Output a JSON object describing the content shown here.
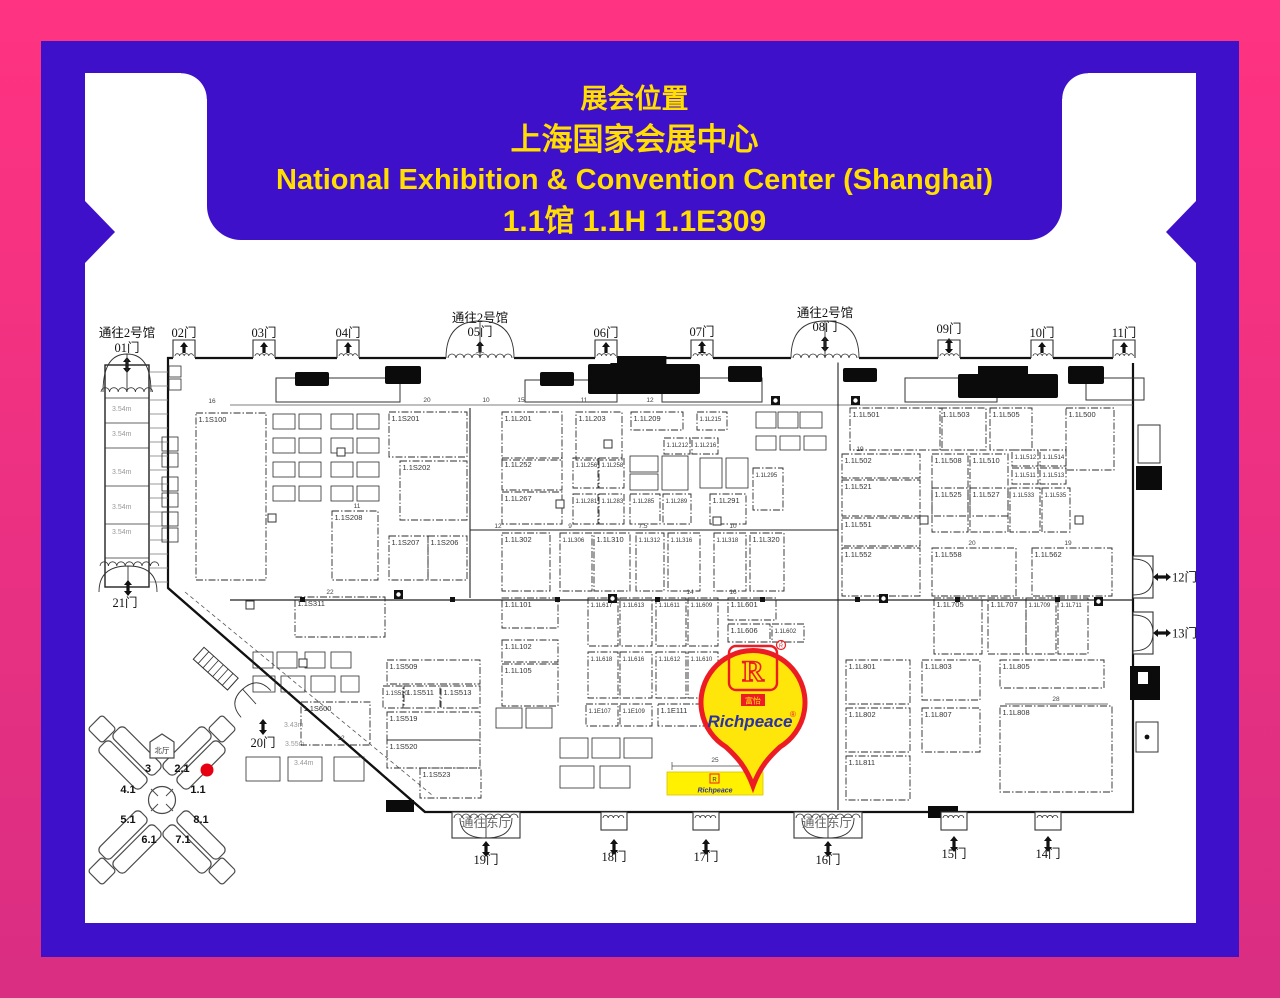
{
  "colors": {
    "frame_pink_top": "#FF3381",
    "frame_pink_bottom": "#D92E82",
    "panel_blue": "#3F10C9",
    "title_yellow": "#FFDE00",
    "pin_red": "#ED1C24",
    "pin_yellow": "#FFE60A",
    "booth_yellow": "#FFF100",
    "brand_blue": "#2B32A3",
    "marker_red": "#E60012"
  },
  "banner": {
    "line1": "展会位置",
    "line2": "上海国家会展中心",
    "line3": "National Exhibition & Convention Center (Shanghai)",
    "line4": "1.1馆 1.1H 1.1E309"
  },
  "map": {
    "heights_corridor": {
      "text": "3.54m",
      "x": 112,
      "ys": [
        411,
        436,
        474,
        509,
        534
      ]
    },
    "heights_diagonal": [
      {
        "text": "3.43m",
        "x": 284,
        "y": 727
      },
      {
        "text": "3.55m",
        "x": 285,
        "y": 746
      },
      {
        "text": "3.44m",
        "x": 294,
        "y": 765
      }
    ],
    "gates_top": [
      {
        "label": "01门",
        "x": 127,
        "y": 352,
        "pass": "通往2号馆",
        "passY": 337,
        "arch": "corridor"
      },
      {
        "label": "02门",
        "x": 184,
        "y": 337
      },
      {
        "label": "03门",
        "x": 264,
        "y": 337
      },
      {
        "label": "04门",
        "x": 348,
        "y": 337
      },
      {
        "label": "05门",
        "x": 480,
        "y": 336,
        "pass": "通往2号馆",
        "passY": 322,
        "arch": true
      },
      {
        "label": "06门",
        "x": 606,
        "y": 337
      },
      {
        "label": "07门",
        "x": 702,
        "y": 336
      },
      {
        "label": "08门",
        "x": 825,
        "y": 331,
        "pass": "通往2号馆",
        "passY": 317,
        "arch": true
      },
      {
        "label": "09门",
        "x": 949,
        "y": 333
      },
      {
        "label": "10门",
        "x": 1042,
        "y": 337
      },
      {
        "label": "11门",
        "x": 1124,
        "y": 337
      }
    ],
    "gates_bottom": [
      {
        "label": "19门",
        "x": 486,
        "y": 864,
        "wide": true
      },
      {
        "label": "18门",
        "x": 614,
        "y": 861
      },
      {
        "label": "17门",
        "x": 706,
        "y": 861
      },
      {
        "label": "16门",
        "x": 828,
        "y": 864,
        "wide": true
      },
      {
        "label": "15门",
        "x": 954,
        "y": 858
      },
      {
        "label": "14门",
        "x": 1048,
        "y": 858
      }
    ],
    "gates_right": [
      {
        "label": "12门",
        "y": 577
      },
      {
        "label": "13门",
        "y": 633
      }
    ],
    "gate_20": {
      "label": "20门",
      "x": 263,
      "y": 747
    },
    "gate_21": {
      "label": "21门",
      "x": 125,
      "y": 607
    },
    "east_passages": [
      {
        "text": "通往东厅",
        "x": 486,
        "y": 827
      },
      {
        "text": "通往东厅",
        "x": 827,
        "y": 827
      }
    ],
    "booths": [
      [
        "1.1S100",
        196,
        413,
        70,
        167
      ],
      [
        "1.1S201",
        389,
        412,
        78,
        45
      ],
      [
        "1.1S202",
        400,
        461,
        67,
        59
      ],
      [
        "1.1S208",
        332,
        511,
        46,
        69
      ],
      [
        "1.1S207",
        389,
        536,
        39,
        44
      ],
      [
        "1.1S206",
        428,
        536,
        39,
        44
      ],
      [
        "1.1S311",
        295,
        597,
        90,
        40
      ],
      [
        "1.1S509",
        387,
        660,
        93,
        24
      ],
      [
        "1.1S510",
        383,
        686,
        20,
        22
      ],
      [
        "1.1S511",
        404,
        686,
        36,
        22
      ],
      [
        "1.1S513",
        441,
        686,
        39,
        22
      ],
      [
        "1.1S519",
        387,
        712,
        93,
        28
      ],
      [
        "1.1S520",
        387,
        740,
        93,
        28
      ],
      [
        "1.1S523",
        420,
        768,
        61,
        30
      ],
      [
        "1.1S600",
        301,
        702,
        69,
        43
      ],
      [
        "1.1L201",
        502,
        412,
        60,
        48
      ],
      [
        "1.1L203",
        576,
        412,
        46,
        48
      ],
      [
        "1.1L209",
        631,
        412,
        52,
        18
      ],
      [
        "1.1L215",
        697,
        412,
        30,
        18
      ],
      [
        "1.1L212",
        664,
        438,
        26,
        16
      ],
      [
        "1.1L216",
        692,
        438,
        26,
        16
      ],
      [
        "1.1L252",
        502,
        458,
        60,
        32
      ],
      [
        "1.1L256",
        573,
        458,
        25,
        30
      ],
      [
        "1.1L258",
        599,
        458,
        25,
        30
      ],
      [
        "1.1L295",
        753,
        468,
        30,
        42
      ],
      [
        "1.1L267",
        502,
        492,
        60,
        32
      ],
      [
        "1.1L281",
        573,
        494,
        25,
        30
      ],
      [
        "1.1L283",
        599,
        494,
        25,
        30
      ],
      [
        "1.1L285",
        630,
        494,
        30,
        30
      ],
      [
        "1.1L289",
        663,
        494,
        28,
        30
      ],
      [
        "1.1L291",
        710,
        494,
        36,
        30
      ],
      [
        "1.1L302",
        502,
        533,
        48,
        58
      ],
      [
        "1.1L306",
        560,
        533,
        32,
        58
      ],
      [
        "1.1L310",
        594,
        533,
        36,
        58
      ],
      [
        "1.1L312",
        636,
        533,
        28,
        58
      ],
      [
        "1.1L316",
        668,
        533,
        32,
        58
      ],
      [
        "1.1L318",
        714,
        533,
        32,
        58
      ],
      [
        "1.1L320",
        750,
        533,
        34,
        58
      ],
      [
        "1.1L101",
        502,
        598,
        56,
        30
      ],
      [
        "1.1L102",
        502,
        640,
        56,
        22
      ],
      [
        "1.1L105",
        502,
        664,
        56,
        42
      ],
      [
        "1.1L617",
        588,
        598,
        30,
        48
      ],
      [
        "1.1L613",
        620,
        598,
        32,
        48
      ],
      [
        "1.1L611",
        656,
        598,
        30,
        48
      ],
      [
        "1.1L609",
        688,
        598,
        30,
        48
      ],
      [
        "1.1L601",
        728,
        598,
        48,
        22
      ],
      [
        "1.1L606",
        728,
        624,
        42,
        18
      ],
      [
        "1.1L602",
        772,
        624,
        32,
        18
      ],
      [
        "1.1L618",
        588,
        652,
        30,
        46
      ],
      [
        "1.1L616",
        620,
        652,
        32,
        46
      ],
      [
        "1.1L612",
        656,
        652,
        30,
        46
      ],
      [
        "1.1L610",
        688,
        652,
        30,
        46
      ],
      [
        "1.1E107",
        586,
        704,
        32,
        22
      ],
      [
        "1.1E109",
        620,
        704,
        32,
        22
      ],
      [
        "1.1E111",
        658,
        704,
        46,
        22
      ],
      [
        "1.1L501",
        850,
        408,
        92,
        42
      ],
      [
        "1.1L503",
        940,
        408,
        46,
        42
      ],
      [
        "1.1L505",
        990,
        408,
        42,
        42
      ],
      [
        "1.1L500",
        1066,
        408,
        48,
        62
      ],
      [
        "1.1L502",
        842,
        454,
        78,
        24
      ],
      [
        "1.1L521",
        842,
        480,
        78,
        36
      ],
      [
        "1.1L508",
        932,
        454,
        36,
        62
      ],
      [
        "1.1L510",
        970,
        454,
        38,
        62
      ],
      [
        "1.1L512",
        1012,
        450,
        26,
        16
      ],
      [
        "1.1L514",
        1040,
        450,
        26,
        16
      ],
      [
        "1.1L511",
        1012,
        468,
        26,
        16
      ],
      [
        "1.1L513",
        1040,
        468,
        26,
        16
      ],
      [
        "1.1L525",
        932,
        488,
        36,
        44
      ],
      [
        "1.1L527",
        970,
        488,
        38,
        44
      ],
      [
        "1.1L533",
        1010,
        488,
        30,
        44
      ],
      [
        "1.1L535",
        1042,
        488,
        28,
        44
      ],
      [
        "1.1L551",
        842,
        518,
        78,
        28
      ],
      [
        "1.1L552",
        842,
        548,
        78,
        48
      ],
      [
        "1.1L558",
        932,
        548,
        84,
        48
      ],
      [
        "1.1L562",
        1032,
        548,
        80,
        48
      ],
      [
        "1.1L705",
        934,
        598,
        48,
        56
      ],
      [
        "1.1L707",
        988,
        598,
        38,
        56
      ],
      [
        "1.1L709",
        1026,
        598,
        30,
        56
      ],
      [
        "1.1L711",
        1058,
        598,
        30,
        56
      ],
      [
        "1.1L801",
        846,
        660,
        64,
        44
      ],
      [
        "1.1L802",
        846,
        708,
        64,
        44
      ],
      [
        "1.1L811",
        846,
        756,
        64,
        44
      ],
      [
        "1.1L803",
        922,
        660,
        58,
        40
      ],
      [
        "1.1L805",
        1000,
        660,
        104,
        28
      ],
      [
        "1.1L807",
        922,
        708,
        58,
        44
      ],
      [
        "1.1L808",
        1000,
        706,
        112,
        86
      ]
    ],
    "blocks": [
      [
        162,
        437,
        16,
        14
      ],
      [
        162,
        453,
        16,
        14
      ],
      [
        162,
        477,
        16,
        14
      ],
      [
        162,
        493,
        16,
        14
      ],
      [
        162,
        512,
        16,
        14
      ],
      [
        162,
        528,
        16,
        14
      ],
      [
        273,
        414,
        22,
        15
      ],
      [
        299,
        414,
        22,
        15
      ],
      [
        331,
        414,
        22,
        15
      ],
      [
        357,
        414,
        22,
        15
      ],
      [
        273,
        438,
        22,
        15
      ],
      [
        299,
        438,
        22,
        15
      ],
      [
        331,
        438,
        22,
        15
      ],
      [
        357,
        438,
        22,
        15
      ],
      [
        273,
        462,
        22,
        15
      ],
      [
        299,
        462,
        22,
        15
      ],
      [
        331,
        462,
        22,
        15
      ],
      [
        357,
        462,
        22,
        15
      ],
      [
        273,
        486,
        22,
        15
      ],
      [
        299,
        486,
        22,
        15
      ],
      [
        331,
        486,
        22,
        15
      ],
      [
        357,
        486,
        22,
        15
      ],
      [
        756,
        412,
        20,
        16
      ],
      [
        778,
        412,
        20,
        16
      ],
      [
        800,
        412,
        22,
        16
      ],
      [
        756,
        436,
        20,
        14
      ],
      [
        780,
        436,
        20,
        14
      ],
      [
        804,
        436,
        22,
        14
      ],
      [
        630,
        456,
        28,
        16
      ],
      [
        630,
        474,
        28,
        16
      ],
      [
        662,
        456,
        26,
        34
      ],
      [
        700,
        458,
        22,
        30
      ],
      [
        726,
        458,
        22,
        30
      ],
      [
        560,
        738,
        28,
        20
      ],
      [
        592,
        738,
        28,
        20
      ],
      [
        624,
        738,
        28,
        20
      ],
      [
        560,
        766,
        34,
        22
      ],
      [
        600,
        766,
        30,
        22
      ],
      [
        253,
        652,
        20,
        16
      ],
      [
        277,
        652,
        20,
        16
      ],
      [
        305,
        652,
        20,
        16
      ],
      [
        331,
        652,
        20,
        16
      ],
      [
        253,
        676,
        22,
        16
      ],
      [
        281,
        676,
        24,
        16
      ],
      [
        311,
        676,
        24,
        16
      ],
      [
        341,
        676,
        18,
        16
      ],
      [
        246,
        757,
        34,
        24
      ],
      [
        288,
        757,
        34,
        24
      ],
      [
        334,
        757,
        30,
        24
      ],
      [
        496,
        708,
        26,
        20
      ],
      [
        526,
        708,
        26,
        20
      ],
      [
        169,
        366,
        12,
        11
      ],
      [
        169,
        379,
        12,
        11
      ]
    ],
    "desks": [
      [
        276,
        378,
        124,
        24
      ],
      [
        525,
        380,
        92,
        22
      ],
      [
        662,
        378,
        100,
        24
      ],
      [
        905,
        378,
        92,
        24
      ],
      [
        1086,
        378,
        58,
        22
      ]
    ],
    "furniture": [
      [
        295,
        372,
        34,
        14,
        0
      ],
      [
        385,
        366,
        36,
        18,
        0
      ],
      [
        540,
        372,
        34,
        14,
        0
      ],
      [
        588,
        364,
        112,
        30,
        1
      ],
      [
        728,
        366,
        34,
        16,
        0
      ],
      [
        843,
        368,
        34,
        14,
        0
      ],
      [
        958,
        374,
        100,
        24,
        1
      ],
      [
        1068,
        366,
        36,
        18,
        0
      ]
    ],
    "dims": [
      [
        "16",
        212,
        403
      ],
      [
        "20",
        427,
        402
      ],
      [
        "10",
        486,
        402
      ],
      [
        "15",
        521,
        402
      ],
      [
        "11",
        584,
        402
      ],
      [
        "12",
        650,
        402
      ],
      [
        "19",
        860,
        451
      ],
      [
        "22",
        330,
        594
      ],
      [
        "11",
        357,
        508
      ],
      [
        "14",
        690,
        594
      ],
      [
        "16",
        733,
        594
      ],
      [
        "12",
        498,
        528
      ],
      [
        "9",
        570,
        528
      ],
      [
        "7.5",
        643,
        528
      ],
      [
        "10",
        733,
        528
      ],
      [
        "20",
        972,
        545
      ],
      [
        "19",
        1068,
        545
      ],
      [
        "25",
        715,
        762
      ],
      [
        "28",
        1056,
        701
      ],
      [
        "12",
        341,
        740
      ]
    ],
    "aisle_dots": [
      300,
      450,
      555,
      655,
      760,
      855,
      955,
      1055
    ],
    "hollow_squares": [
      [
        337,
        448
      ],
      [
        268,
        514
      ],
      [
        246,
        601
      ],
      [
        556,
        500
      ],
      [
        713,
        517
      ],
      [
        299,
        659
      ],
      [
        1075,
        516
      ],
      [
        920,
        516
      ],
      [
        604,
        440
      ]
    ],
    "wheelchairs": [
      [
        771,
        396
      ],
      [
        851,
        396
      ],
      [
        608,
        594
      ],
      [
        394,
        590
      ],
      [
        879,
        594
      ],
      [
        1094,
        597
      ]
    ],
    "pin": {
      "brand": "Richpeace",
      "logo_letter": "R",
      "logo_sub": "富怡",
      "reg": "®"
    },
    "booth_highlight": {
      "brand": "Richpeace",
      "logo_letter": "R",
      "x": 667,
      "y": 772,
      "w": 96,
      "h": 23
    },
    "minimap": {
      "north": "北厅",
      "halls": [
        {
          "id": "2.1",
          "cx": 187,
          "cy": 751,
          "a": -45,
          "lx": 182,
          "ly": 772
        },
        {
          "id": "1.1",
          "cx": 201,
          "cy": 765,
          "a": -45,
          "lx": 198,
          "ly": 793
        },
        {
          "id": "3",
          "cx": 137,
          "cy": 751,
          "a": 45,
          "lx": 148,
          "ly": 772
        },
        {
          "id": "4.1",
          "cx": 123,
          "cy": 765,
          "a": 45,
          "lx": 128,
          "ly": 793
        },
        {
          "id": "5.1",
          "cx": 123,
          "cy": 835,
          "a": -45,
          "lx": 128,
          "ly": 823
        },
        {
          "id": "6.1",
          "cx": 137,
          "cy": 849,
          "a": -45,
          "lx": 149,
          "ly": 843
        },
        {
          "id": "8.1",
          "cx": 201,
          "cy": 835,
          "a": 45,
          "lx": 201,
          "ly": 823
        },
        {
          "id": "7.1",
          "cx": 187,
          "cy": 849,
          "a": 45,
          "lx": 183,
          "ly": 843
        }
      ],
      "dot": {
        "x": 207,
        "y": 770
      }
    }
  }
}
